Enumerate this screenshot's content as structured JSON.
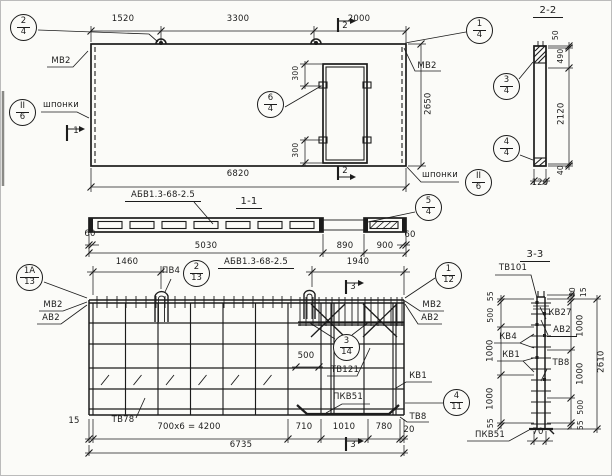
{
  "plan": {
    "dim_1520": "1520",
    "dim_3300": "3300",
    "dim_2000": "2000",
    "dim_2650": "2650",
    "dim_6820": "6820",
    "dim_300_top": "300",
    "dim_300_bot": "300",
    "label_mv2_left": "МВ2",
    "label_mv2_right": "МВ2",
    "label_keys_left": "шпонки",
    "label_keys_right": "шпонки",
    "sec1": "1",
    "sec2_top": "2",
    "sec2_bot": "2"
  },
  "sec11": {
    "title": "1-1",
    "mark": "АБВ1.3-68-2.5",
    "dim_60_left": "60",
    "dim_5030": "5030",
    "dim_890": "890",
    "dim_900": "900",
    "dim_60_right": "60"
  },
  "sec22": {
    "title": "2-2",
    "dim_50": "50",
    "dim_490": "490",
    "dim_2120": "2120",
    "dim_40": "40",
    "dim_120": "120"
  },
  "reinf": {
    "dim_1460": "1460",
    "dim_1940": "1940",
    "label_pv4": "ПВ4",
    "mark": "АБВ1.3-68-2.5",
    "label_mv2_left": "МВ2",
    "label_av2_left": "АВ2",
    "label_mv2_right": "МВ2",
    "label_av2_right": "АВ2",
    "dim_500": "500",
    "label_tv121": "ТВ121",
    "label_kv1": "КВ1",
    "label_pkv51": "ПКВ51",
    "label_tv8": "ТВ8",
    "label_tv78": "ТВ78",
    "dim_15": "15",
    "dim_700x6": "700х6 = 4200",
    "dim_710": "710",
    "dim_1010": "1010",
    "dim_780": "780",
    "dim_20": "20",
    "dim_6735": "6735",
    "sec3_top": "3",
    "sec3_bot": "3"
  },
  "sec33": {
    "title": "3-3",
    "label_tv101": "ТВ101",
    "label_kv27": "КВ27",
    "label_av2": "АВ2",
    "label_kv4": "КВ4",
    "label_kv1": "КВ1",
    "label_tv8": "ТВ8",
    "label_pkv51": "ПКВ51",
    "dim_55_tl": "55",
    "dim_500_l": "500",
    "dim_1000_l1": "1000",
    "dim_1000_l2": "1000",
    "dim_55_bl": "55",
    "dim_40": "40",
    "dim_15": "15",
    "dim_1000_r1": "1000",
    "dim_1000_r2": "1000",
    "dim_500_r": "500",
    "dim_55_br": "55",
    "dim_2610": "2610",
    "dim_70": "70"
  },
  "callouts": {
    "c24": {
      "top": "2",
      "bot": "4"
    },
    "c14": {
      "top": "1",
      "bot": "4"
    },
    "c64": {
      "top": "6",
      "bot": "4"
    },
    "cII6l": {
      "top": "II",
      "bot": "6"
    },
    "cII6r": {
      "top": "II",
      "bot": "6"
    },
    "c34": {
      "top": "3",
      "bot": "4"
    },
    "c44": {
      "top": "4",
      "bot": "4"
    },
    "c54": {
      "top": "5",
      "bot": "4"
    },
    "c1a13": {
      "top": "1А",
      "bot": "13"
    },
    "c213": {
      "top": "2",
      "bot": "13"
    },
    "c112": {
      "top": "1",
      "bot": "12"
    },
    "c314": {
      "top": "3",
      "bot": "14"
    },
    "c411": {
      "top": "4",
      "bot": "11"
    }
  }
}
